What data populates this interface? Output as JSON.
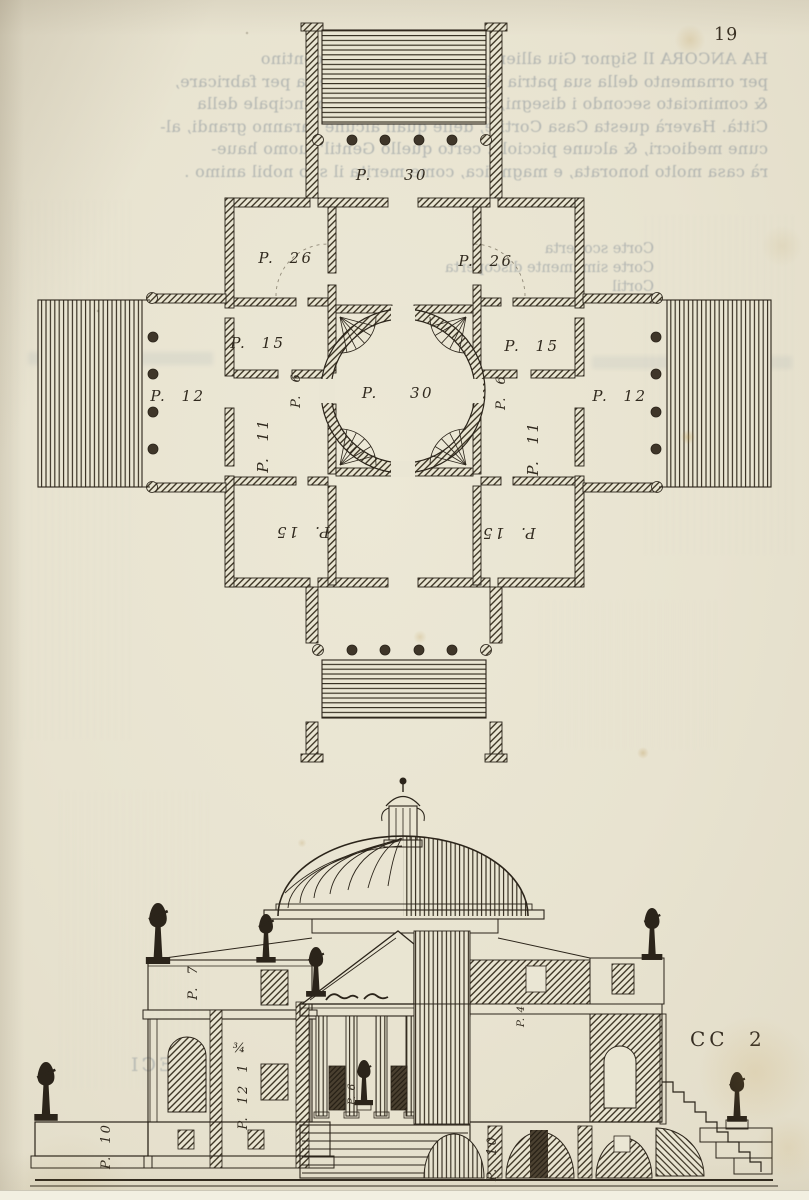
{
  "page": {
    "number": "19",
    "signature": "CC 2"
  },
  "colors": {
    "paper": "#eae6d4",
    "ink": "#2b241a",
    "ghost_text": "#6876 88",
    "stain": "#c39b52"
  },
  "plan": {
    "labels": [
      {
        "id": "top-portico-width",
        "text": "P. 30"
      },
      {
        "id": "room-26-left",
        "text": "P. 26"
      },
      {
        "id": "room-26-right",
        "text": "P. 26"
      },
      {
        "id": "room-15-left",
        "text": "P. 15"
      },
      {
        "id": "room-15-right",
        "text": "P. 15"
      },
      {
        "id": "portico-left-depth",
        "text": "P. 12"
      },
      {
        "id": "portico-right-depth",
        "text": "P. 12"
      },
      {
        "id": "central-hall-diameter",
        "text": "P. 30"
      },
      {
        "id": "passage-left",
        "text": "P. 6"
      },
      {
        "id": "passage-right",
        "text": "P. 6"
      },
      {
        "id": "room-11-left",
        "text": "P. 11"
      },
      {
        "id": "room-11-right",
        "text": "P. 11"
      },
      {
        "id": "room-15-bottom-left",
        "text": "P. 15"
      },
      {
        "id": "room-15-bottom-right",
        "text": "P. 15"
      }
    ]
  },
  "section": {
    "labels": [
      {
        "id": "attic-height",
        "text": "P. 7"
      },
      {
        "id": "fraction",
        "text": "¾"
      },
      {
        "id": "storey-height",
        "text": "P. 12 1"
      },
      {
        "id": "door-width",
        "text": "P. 6"
      },
      {
        "id": "wall-dim",
        "text": "P. 4"
      },
      {
        "id": "terrace-left-height",
        "text": "P. 10"
      },
      {
        "id": "basement-height",
        "text": "P. 10"
      }
    ]
  },
  "ghost_text": {
    "paragraph": [
      "HA ANCORA Il Signor Giu          alliere, & Gentil'huomo Vicentino",
      "per ornamento della sua patria più          preparata la materia per fabricare,",
      "& cominciato secondo i disegni, che          sopra la strada principale della",
      "Città. Haverà questa Casa Cortile,          delle quali alcune saranno grandi, al-",
      "cune mediocri, & alcune picciole.          certo quello Gentil'huomo haue-",
      "rà casa molto honorata, e magnifica, come merita il suo nobil animo ."
    ],
    "legend": [
      "Corte scoperta",
      "Corte similmente discoperta",
      "Cortil"
    ],
    "word": "FECI"
  }
}
